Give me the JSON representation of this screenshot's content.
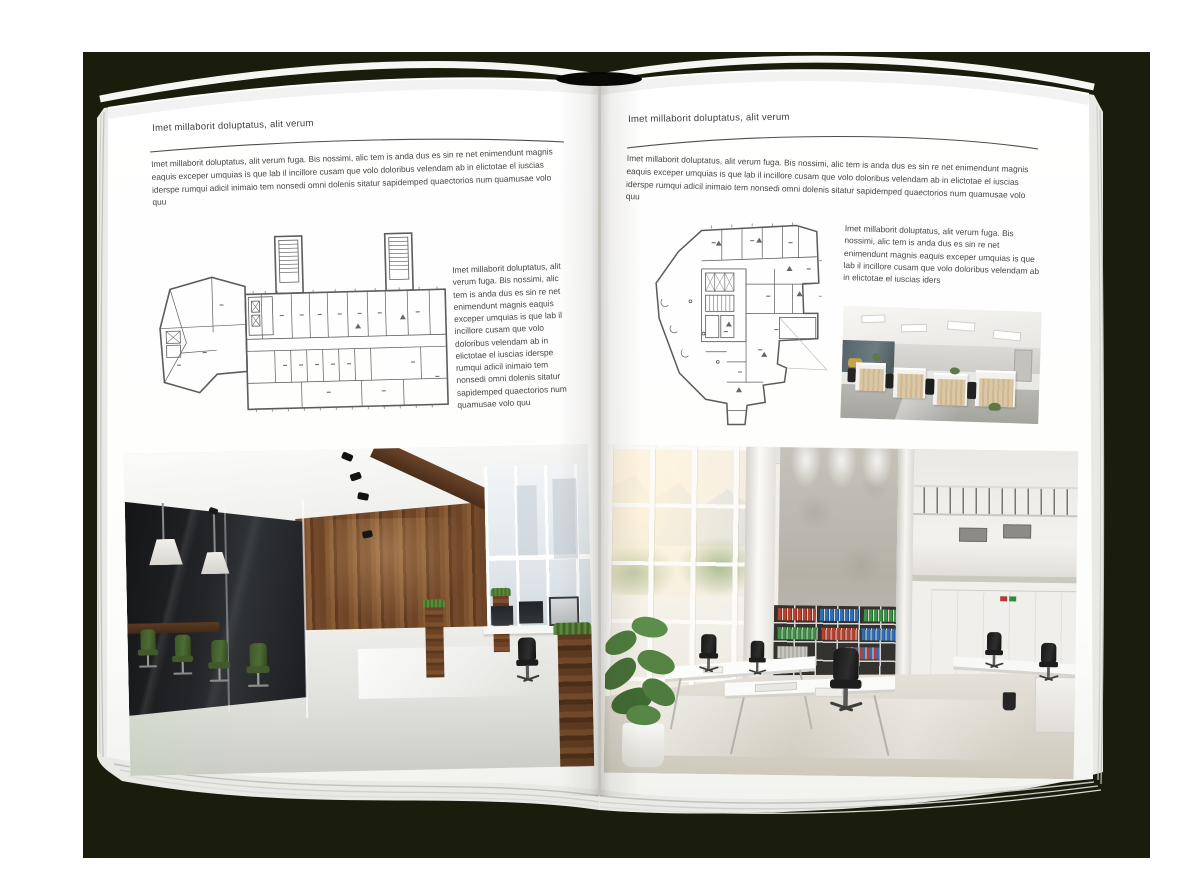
{
  "book": {
    "colors": {
      "backdrop": "#1a1d0c",
      "page": "#ffffff",
      "text": "#3d3d3d",
      "rule": "#4f4f4f"
    },
    "left_page": {
      "header": "Imet millaborit doluptatus, alit verum",
      "body": "Imet millaborit doluptatus, alit verum fuga. Bis nossimi, alic tem is anda dus es sin re net enimendunt magnis eaquis exceper umquias is que lab il incillore cusam que volo doloribus velendam ab in elictotae el iuscias iderspe rumqui adicil inimaio tem nonsedi omni dolenis sitatur sapidemped quaectorios num quamusae volo quu",
      "side_text": "Imet millaborit doluptatus, alit verum fuga. Bis nossimi, alic tem is anda dus es sin re net enimendunt magnis eaquis exceper umquias is que lab il incillore cusam que volo doloribus velendam ab in elictotae el iuscias iderspe rumqui adicil inimaio tem nonsedi omni dolenis sitatur sapidemped quaectorios num quamusae volo quu"
    },
    "right_page": {
      "header": "Imet millaborit doluptatus, alit verum",
      "body": "Imet millaborit doluptatus, alit verum fuga. Bis nossimi, alic tem is anda dus es sin re net enimendunt magnis eaquis exceper umquias is que lab il incillore cusam que volo doloribus velendam ab in elictotae el iuscias iderspe rumqui adicil inimaio tem nonsedi omni dolenis sitatur sapidemped quaectorios num quamusae volo quu",
      "side_text": "Imet millaborit doluptatus, alit verum fuga. Bis nossimi, alic tem is anda dus es sin re net enimendunt magnis eaquis exceper umquias is que lab il incillore cusam que volo doloribus velendam ab in elictotae el iuscias iders"
    }
  }
}
